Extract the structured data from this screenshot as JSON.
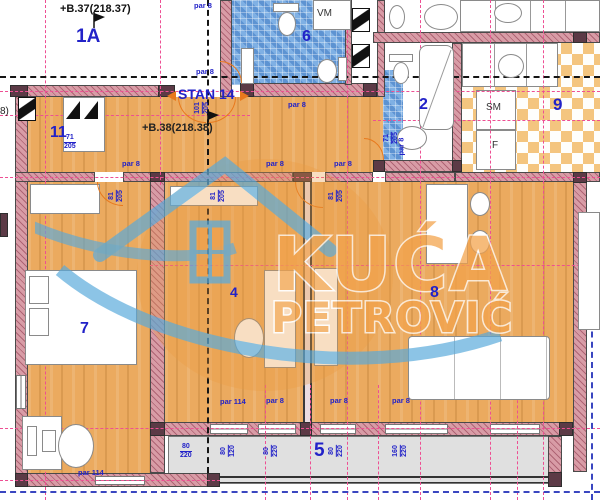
{
  "labels": {
    "unit_1a": "1A",
    "stan": "STAN 14",
    "elev_top": "+B.37(218.37)",
    "elev_mid": "+B.38(218.38)",
    "elev_left": "8)",
    "vm": "VM",
    "sm": "SM",
    "f": "F",
    "par8": "par 8",
    "par114": "par 114"
  },
  "rooms": {
    "hall": "11",
    "bath_small": "6",
    "bath_main": "2",
    "kitchen": "9",
    "bedroom_left": "7",
    "bedroom_mid": "4",
    "living": "8",
    "terrace": "5"
  },
  "dims": {
    "hall_door": {
      "a": "71",
      "b": "205"
    },
    "entry_door": {
      "a": "101",
      "b": "205"
    },
    "door_7": {
      "a": "81",
      "b": "205"
    },
    "door_4": {
      "a": "81",
      "b": "205"
    },
    "door_8": {
      "a": "81",
      "b": "205"
    },
    "bath_door": {
      "a": "71",
      "b": "205"
    },
    "windows": [
      {
        "a": "80",
        "b": "220"
      },
      {
        "a": "80",
        "b": "120"
      },
      {
        "a": "80",
        "b": "220"
      },
      {
        "a": "80",
        "b": "220"
      },
      {
        "a": "160",
        "b": "220"
      }
    ]
  },
  "watermark": {
    "line1": "KUĆA",
    "line2": "PETROVIĆ"
  },
  "colors": {
    "floor": "#EBAA5F",
    "wall_fill": "#D89CA6",
    "tile_blue": "#6FA3DE",
    "checker_orange": "#F4C57F",
    "axis_pink": "#EE4F93",
    "axis_blue": "#3A46C0",
    "label_blue": "#2222C8",
    "accent_orange": "#E8791D",
    "terrace_gray": "#E0E0E0"
  }
}
